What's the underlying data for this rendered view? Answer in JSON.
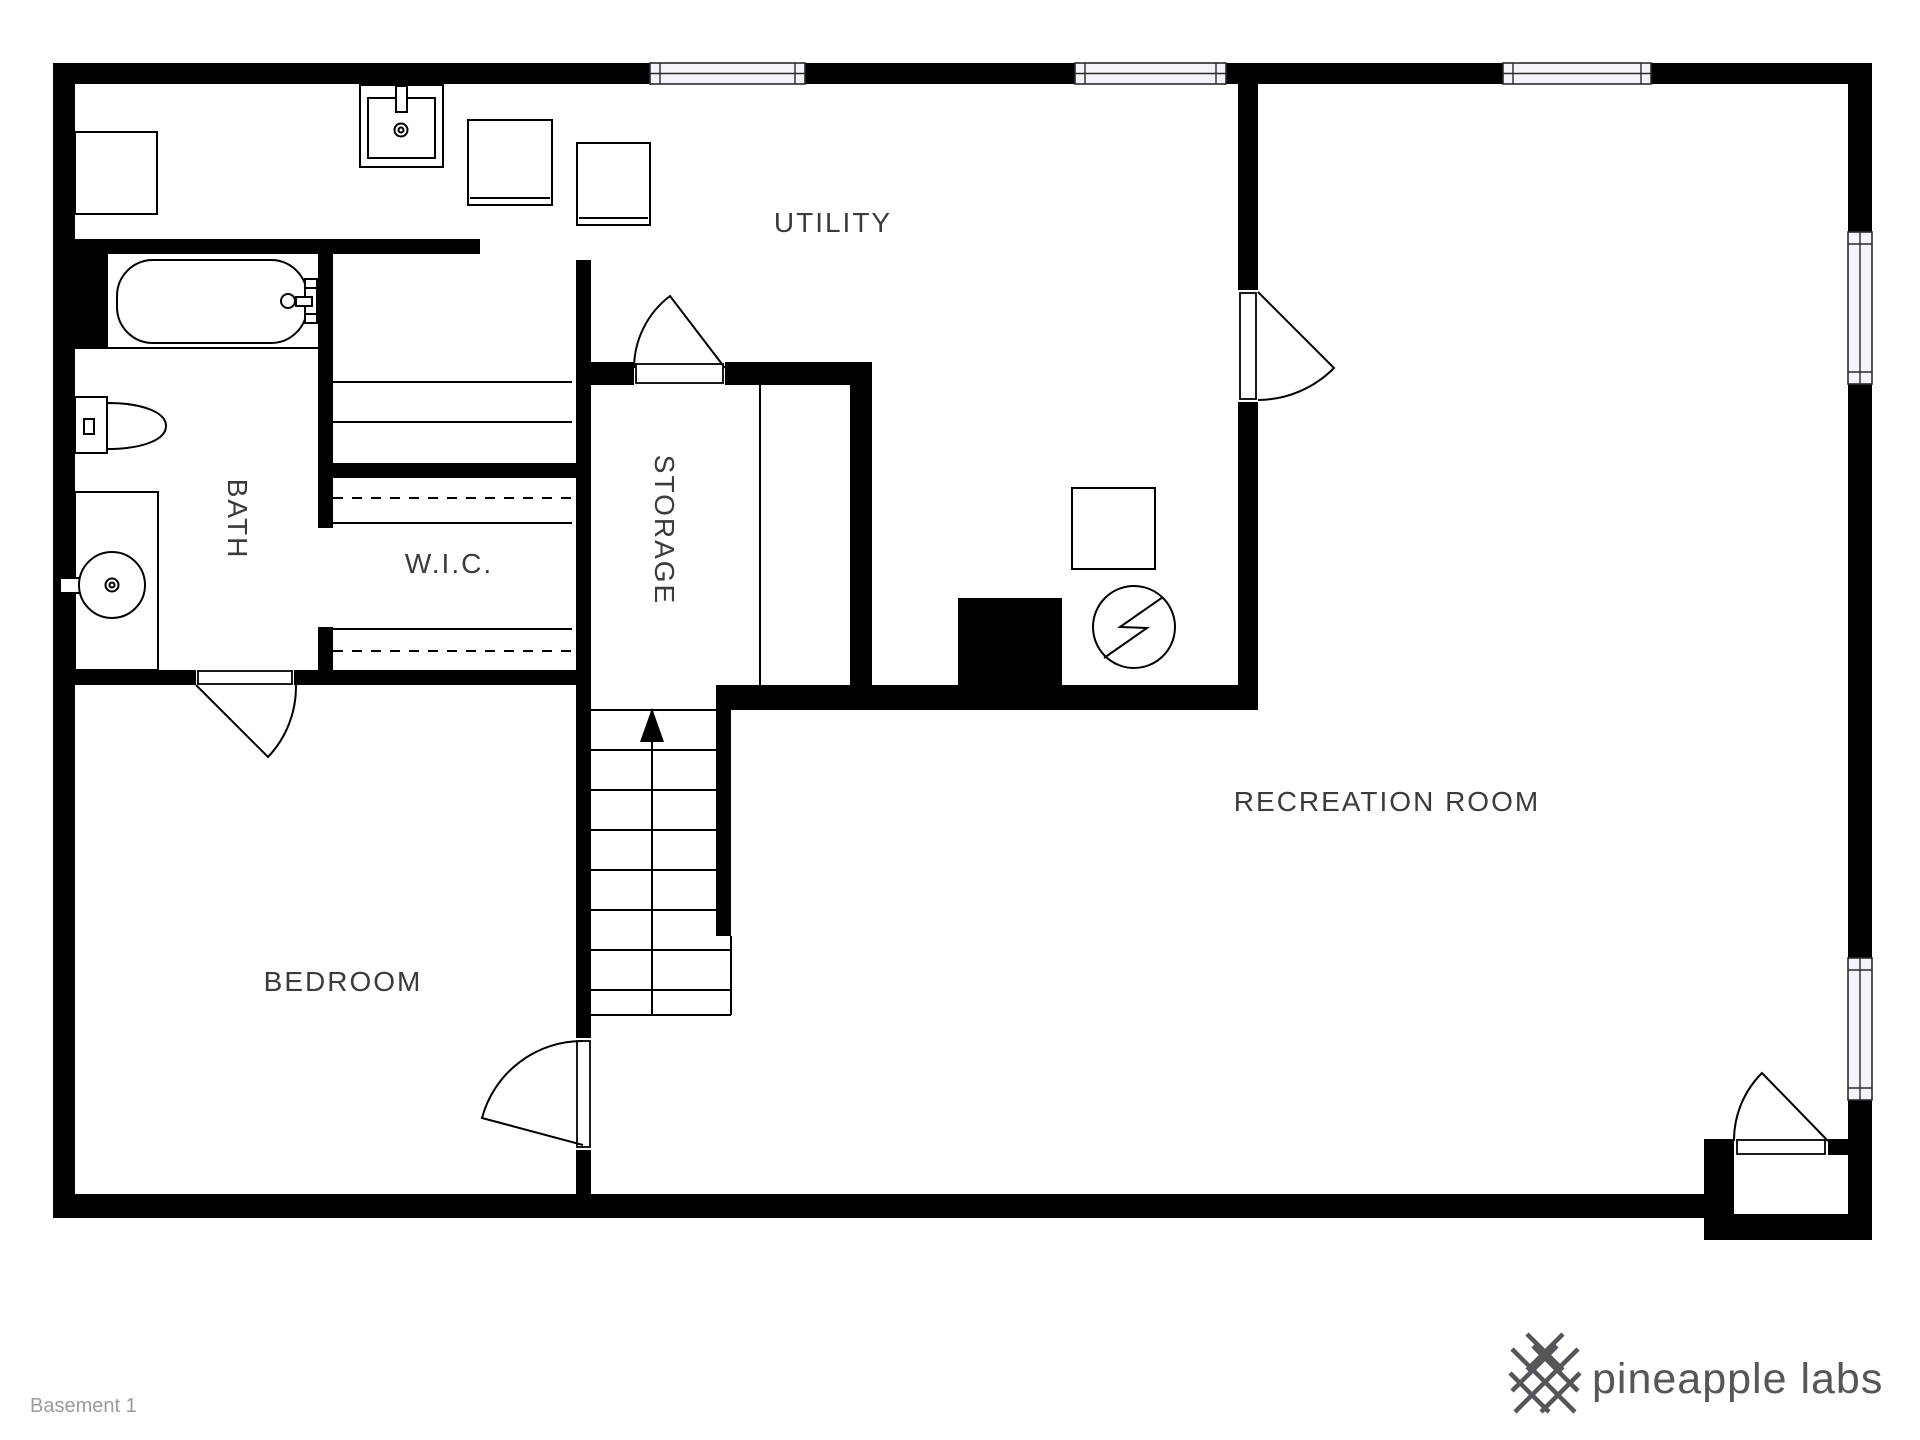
{
  "floorplan": {
    "title": "Basement 1",
    "rooms": {
      "utility": {
        "label": "UTILITY"
      },
      "bath": {
        "label": "BATH",
        "orientation": "vertical"
      },
      "wic": {
        "label": "W.I.C."
      },
      "storage": {
        "label": "STORAGE",
        "orientation": "vertical"
      },
      "bedroom": {
        "label": "BEDROOM"
      },
      "recreation": {
        "label": "RECREATION ROOM"
      }
    },
    "fixtures": [
      "water-heater",
      "utility-sink",
      "washer",
      "dryer",
      "bathtub",
      "toilet",
      "vanity-sink",
      "electrical-panel",
      "hvac-unit",
      "stairs-up"
    ],
    "window_count": 5,
    "door_count": 5
  },
  "branding": {
    "logo_text": "pineapple labs"
  },
  "colors": {
    "wall": "#000000",
    "room_label": "#3b3b3b",
    "floor_label_muted": "#9b9b9b",
    "brand_gray": "#55565a",
    "window_fill": "#f4f4fb",
    "background": "#ffffff"
  }
}
